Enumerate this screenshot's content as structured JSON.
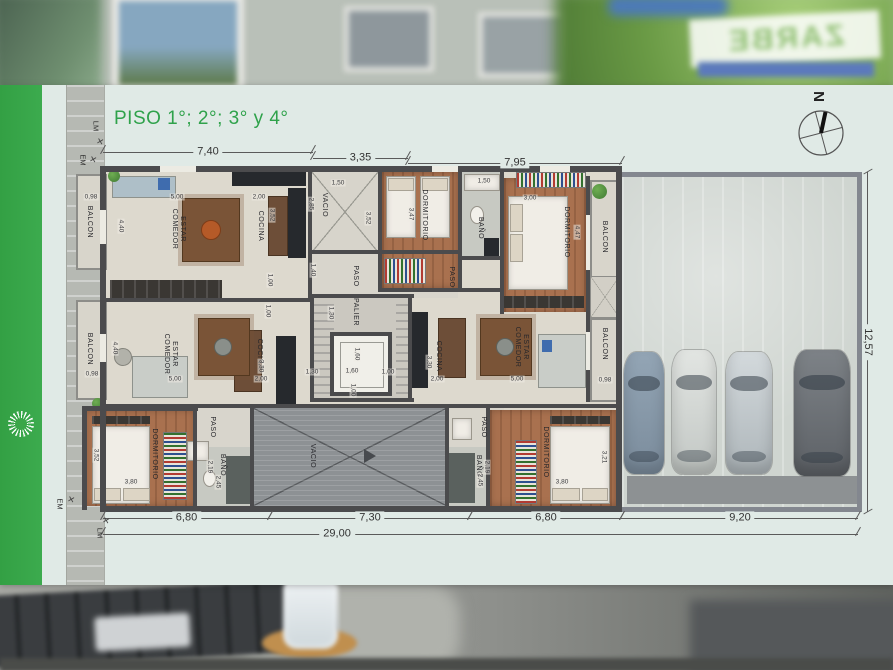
{
  "plan": {
    "title": "PISO 1°; 2°; 3° y 4°",
    "dims": {
      "top": [
        "7,40",
        "3,35",
        "7,95"
      ],
      "bottom": [
        "6,80",
        "7,30",
        "6,80",
        "9,20"
      ],
      "total": "29,00",
      "right": "12,57"
    },
    "boundary_markers": [
      {
        "t": "LM",
        "x": 96,
        "y": 126,
        "r": 1
      },
      {
        "t": "EM",
        "x": 83,
        "y": 160,
        "r": 1
      },
      {
        "t": "EM",
        "x": 60,
        "y": 504,
        "r": 1
      },
      {
        "t": "LM",
        "x": 100,
        "y": 533,
        "r": 1
      }
    ],
    "survey_ticks": [
      {
        "t": "✕",
        "x": 100,
        "y": 142
      },
      {
        "t": "✕",
        "x": 93,
        "y": 160
      },
      {
        "t": "✕",
        "x": 71,
        "y": 500
      },
      {
        "t": "✕",
        "x": 106,
        "y": 521
      }
    ],
    "room_labels": [
      {
        "t": "BALCON",
        "x": 89,
        "y": 222,
        "r": 1
      },
      {
        "t": "ESTAR\nCOMEDOR",
        "x": 178,
        "y": 229,
        "r": 1
      },
      {
        "t": "COCINA",
        "x": 260,
        "y": 226,
        "r": 1
      },
      {
        "t": "VACIO",
        "x": 324,
        "y": 205,
        "r": 1
      },
      {
        "t": "DORMITORIO",
        "x": 424,
        "y": 215,
        "r": 1
      },
      {
        "t": "BAÑO",
        "x": 480,
        "y": 228,
        "r": 1
      },
      {
        "t": "DORMITORIO",
        "x": 566,
        "y": 232,
        "r": 1
      },
      {
        "t": "BALCON",
        "x": 604,
        "y": 237,
        "r": 1
      },
      {
        "t": "PASO",
        "x": 355,
        "y": 276,
        "r": 1
      },
      {
        "t": "PASO",
        "x": 451,
        "y": 277,
        "r": 1
      },
      {
        "t": "PALIER",
        "x": 355,
        "y": 312,
        "r": 1
      },
      {
        "t": "BALCON",
        "x": 89,
        "y": 349,
        "r": 1
      },
      {
        "t": "ESTAR\nCOMEDOR",
        "x": 170,
        "y": 354,
        "r": 1
      },
      {
        "t": "COCINA",
        "x": 259,
        "y": 354,
        "r": 1
      },
      {
        "t": "COCINA",
        "x": 438,
        "y": 356,
        "r": 1
      },
      {
        "t": "ESTAR\nCOMEDOR",
        "x": 521,
        "y": 347,
        "r": 1
      },
      {
        "t": "BALCON",
        "x": 604,
        "y": 344,
        "r": 1
      },
      {
        "t": "DORMITORIO",
        "x": 154,
        "y": 454,
        "r": 1
      },
      {
        "t": "PASO",
        "x": 212,
        "y": 427,
        "r": 1
      },
      {
        "t": "BAÑO",
        "x": 222,
        "y": 465,
        "r": 1
      },
      {
        "t": "VACIO",
        "x": 312,
        "y": 456,
        "r": 1
      },
      {
        "t": "PASO",
        "x": 483,
        "y": 427,
        "r": 1
      },
      {
        "t": "BAÑO",
        "x": 478,
        "y": 466,
        "r": 1
      },
      {
        "t": "DORMITORIO",
        "x": 545,
        "y": 452,
        "r": 1
      }
    ],
    "inner_dims": [
      {
        "v": "0,98",
        "x": 91,
        "y": 197
      },
      {
        "v": "4,40",
        "x": 121,
        "y": 226,
        "r": 1
      },
      {
        "v": "5,00",
        "x": 177,
        "y": 197
      },
      {
        "v": "2,00",
        "x": 259,
        "y": 197
      },
      {
        "v": "3,52",
        "x": 272,
        "y": 215,
        "r": 1
      },
      {
        "v": "2,85",
        "x": 311,
        "y": 204,
        "r": 1
      },
      {
        "v": "1,50",
        "x": 338,
        "y": 183
      },
      {
        "v": "3,52",
        "x": 368,
        "y": 218,
        "r": 1
      },
      {
        "v": "3,47",
        "x": 411,
        "y": 214,
        "r": 1
      },
      {
        "v": "1,50",
        "x": 484,
        "y": 181
      },
      {
        "v": "3,00",
        "x": 530,
        "y": 198
      },
      {
        "v": "4,47",
        "x": 577,
        "y": 232,
        "r": 1
      },
      {
        "v": "1,00",
        "x": 270,
        "y": 280,
        "r": 1
      },
      {
        "v": "1,40",
        "x": 313,
        "y": 270,
        "r": 1
      },
      {
        "v": "1,00",
        "x": 268,
        "y": 311,
        "r": 1
      },
      {
        "v": "1,30",
        "x": 331,
        "y": 313,
        "r": 1
      },
      {
        "v": "1,30",
        "x": 312,
        "y": 372
      },
      {
        "v": "1,60",
        "x": 352,
        "y": 371
      },
      {
        "v": "1,60",
        "x": 357,
        "y": 354,
        "r": 1
      },
      {
        "v": "1,00",
        "x": 388,
        "y": 372
      },
      {
        "v": "1,00",
        "x": 353,
        "y": 390,
        "r": 1
      },
      {
        "v": "3,30",
        "x": 261,
        "y": 366,
        "r": 1
      },
      {
        "v": "2,00",
        "x": 261,
        "y": 379
      },
      {
        "v": "5,00",
        "x": 175,
        "y": 379
      },
      {
        "v": "4,40",
        "x": 115,
        "y": 348,
        "r": 1
      },
      {
        "v": "0,98",
        "x": 92,
        "y": 374
      },
      {
        "v": "3,30",
        "x": 429,
        "y": 362,
        "r": 1
      },
      {
        "v": "2,00",
        "x": 437,
        "y": 379
      },
      {
        "v": "5,00",
        "x": 517,
        "y": 379
      },
      {
        "v": "0,98",
        "x": 605,
        "y": 380
      },
      {
        "v": "3,52",
        "x": 96,
        "y": 455,
        "r": 1
      },
      {
        "v": "3,80",
        "x": 131,
        "y": 482
      },
      {
        "v": "2,19",
        "x": 210,
        "y": 467,
        "r": 1
      },
      {
        "v": "2,45",
        "x": 218,
        "y": 482,
        "r": 1
      },
      {
        "v": "2,19",
        "x": 487,
        "y": 467,
        "r": 1
      },
      {
        "v": "2,45",
        "x": 480,
        "y": 480,
        "r": 1
      },
      {
        "v": "3,80",
        "x": 562,
        "y": 482
      },
      {
        "v": "3,21",
        "x": 604,
        "y": 457,
        "r": 1
      }
    ]
  },
  "compass": {
    "label": "N"
  },
  "background": {
    "sign_text": "ZARBE"
  },
  "colors": {
    "accent_green": "#3aa648",
    "wall": "#4b4b4d",
    "wood": "#a9714f",
    "panel": "#e0eae6",
    "vacio": "#8d9194"
  }
}
